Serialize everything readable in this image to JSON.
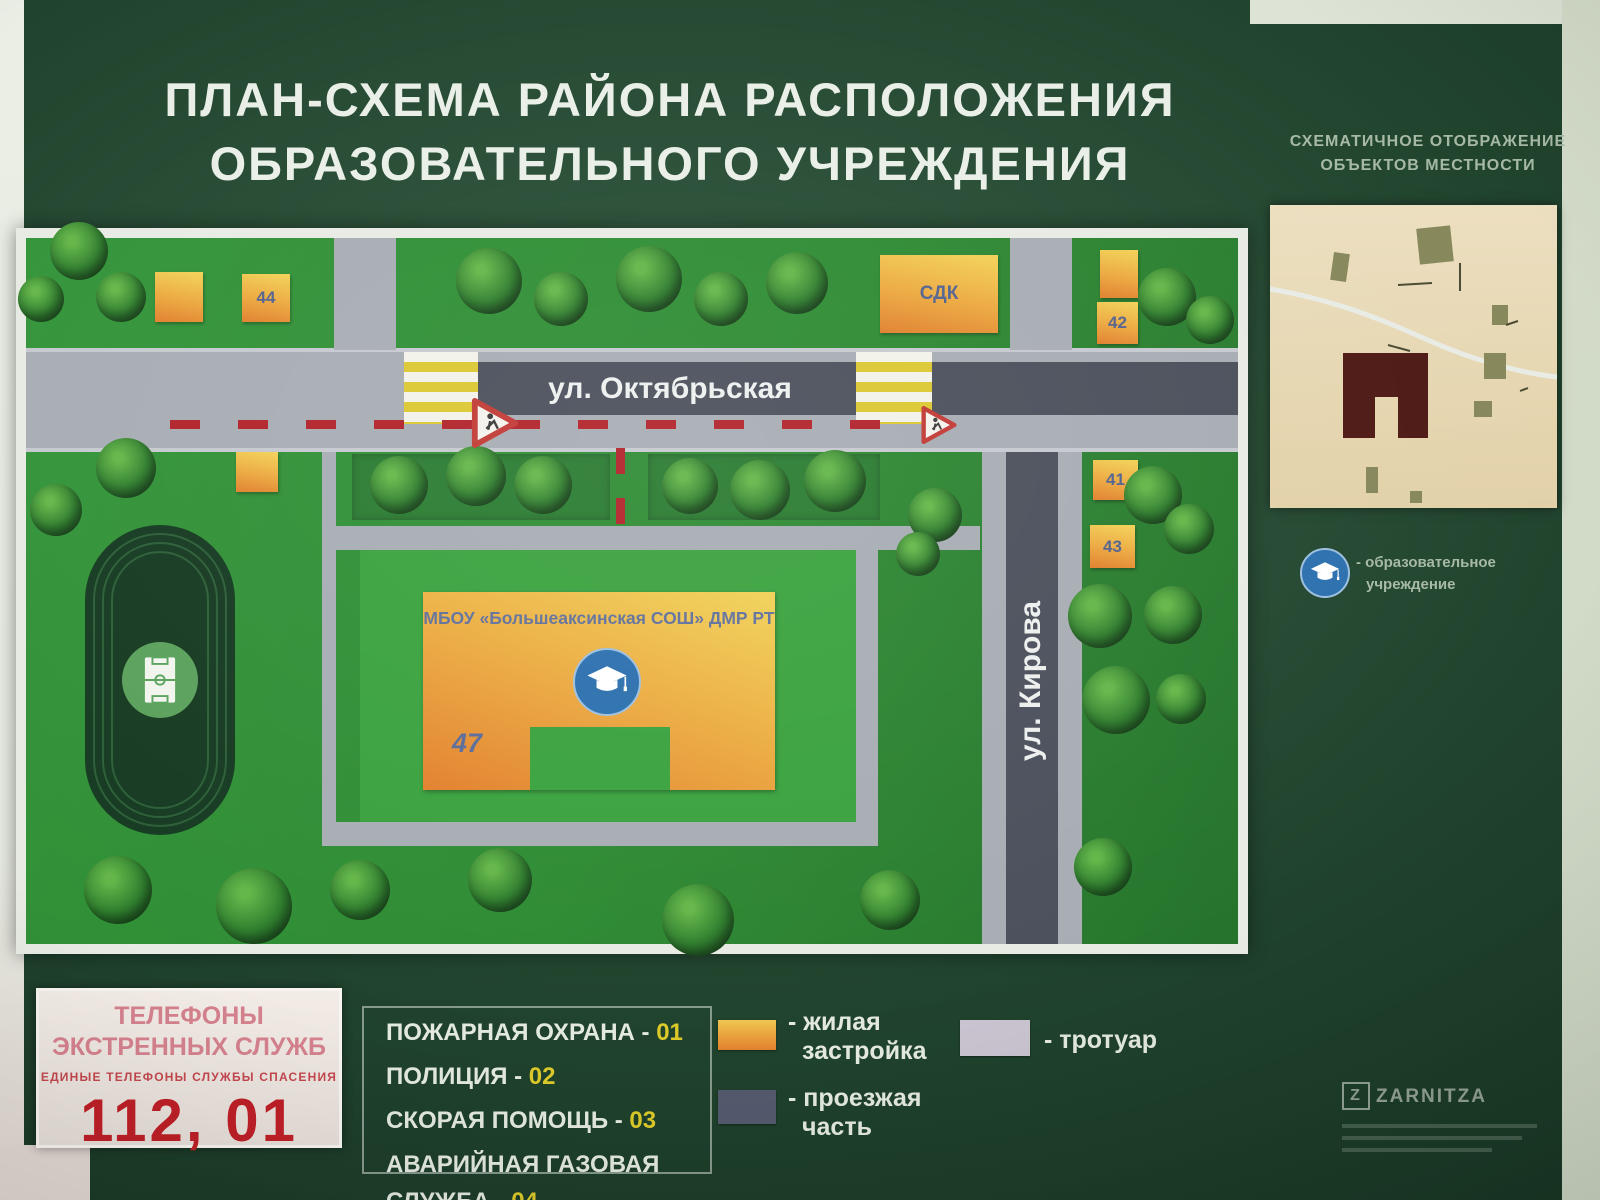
{
  "title": {
    "line1": "ПЛАН-СХЕМА РАЙОНА РАСПОЛОЖЕНИЯ",
    "line2": "ОБРАЗОВАТЕЛЬНОГО УЧРЕЖДЕНИЯ"
  },
  "minimap": {
    "heading_line1": "СХЕМАТИЧНОЕ ОТОБРАЖЕНИЕ",
    "heading_line2": "ОБЪЕКТОВ МЕСТНОСТИ"
  },
  "edu_legend": {
    "line1": "- образовательное",
    "line2": "учреждение"
  },
  "map": {
    "street_oktyabrskaya": "ул. Октябрьская",
    "street_kirova": "ул. Кирова",
    "school_name": "МБОУ «Большеаксинская СОШ» ДМР РТ",
    "school_number": "47",
    "building_sdk": "СДК",
    "building_44": "44",
    "building_42": "42",
    "building_41": "41",
    "building_43": "43"
  },
  "emergency": {
    "title_line1": "ТЕЛЕФОНЫ",
    "title_line2": "ЭКСТРЕННЫХ СЛУЖБ",
    "subtitle": "ЕДИНЫЕ ТЕЛЕФОНЫ СЛУЖБЫ СПАСЕНИЯ",
    "numbers": "112, 01"
  },
  "services": [
    {
      "label": "ПОЖАРНАЯ ОХРАНА - ",
      "num": "01"
    },
    {
      "label": "ПОЛИЦИЯ - ",
      "num": "02"
    },
    {
      "label": "СКОРАЯ ПОМОЩЬ - ",
      "num": "03"
    },
    {
      "label": "АВАРИЙНАЯ ГАЗОВАЯ СЛУЖБА - ",
      "num": "04"
    }
  ],
  "legend": {
    "residential_line1": "- жилая",
    "residential_line2": "застройка",
    "sidewalk": "- тротуар",
    "roadway_line1": "- проезжая",
    "roadway_line2": "часть"
  },
  "icons": {
    "school": "graduation-cap-icon",
    "stadium": "sports-field-icon",
    "road_sign": "children-crossing-sign-icon"
  },
  "colors": {
    "residential_top": "#f0c64f",
    "residential_bottom": "#e2802d",
    "sidewalk": "#c9c3d0",
    "roadway": "#545a6d",
    "accent_number_yellow": "#dcc929",
    "emergency_red": "#bf1f27",
    "map_green": "#2e8b33"
  },
  "branding": {
    "logo": "ZARNITZA"
  }
}
